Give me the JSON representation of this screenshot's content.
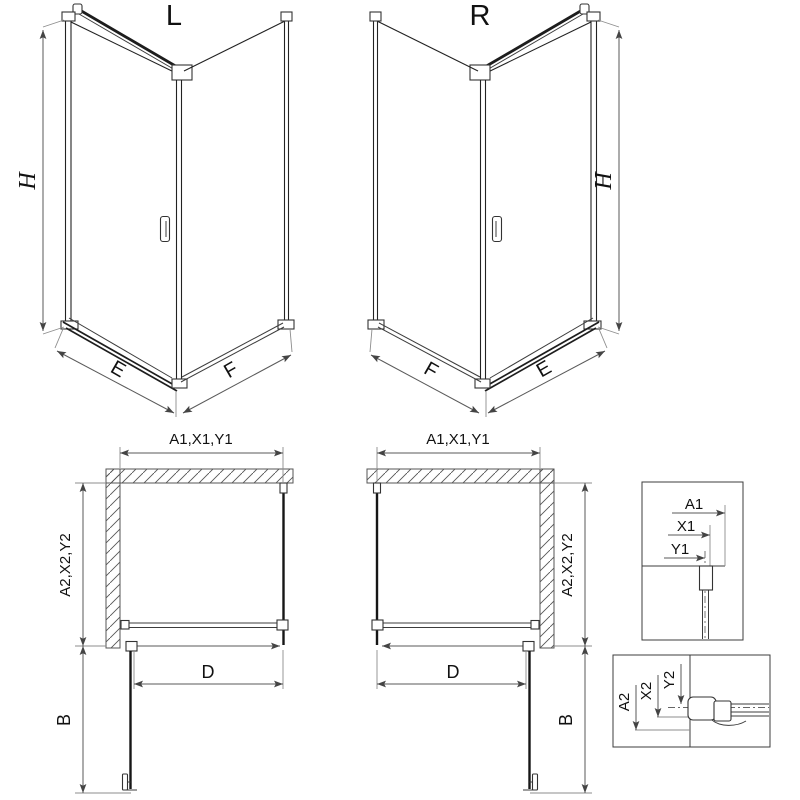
{
  "labels": {
    "left_variant": "L",
    "right_variant": "R"
  },
  "iso_left": {
    "height_dim": "H",
    "front_width_dim": "E",
    "side_width_dim": "F"
  },
  "iso_right": {
    "height_dim": "H",
    "front_width_dim": "E",
    "side_width_dim": "F"
  },
  "plan_left": {
    "top_dim": "A1,X1,Y1",
    "side_dim": "A2,X2,Y2",
    "entry_dim": "D",
    "door_dim": "B"
  },
  "plan_right": {
    "top_dim": "A1,X1,Y1",
    "side_dim": "A2,X2,Y2",
    "entry_dim": "D",
    "door_dim": "B"
  },
  "detail_wall_profile": {
    "dims": [
      "A1",
      "X1",
      "Y1"
    ]
  },
  "detail_door_profile": {
    "dims": [
      "A2",
      "X2",
      "Y2"
    ]
  },
  "colors": {
    "background": "#ffffff",
    "line": "#3c3c3c",
    "glass": "#161616",
    "dimension": "#5a5a5a",
    "extension": "#8c8c8c",
    "text": "#111111"
  }
}
